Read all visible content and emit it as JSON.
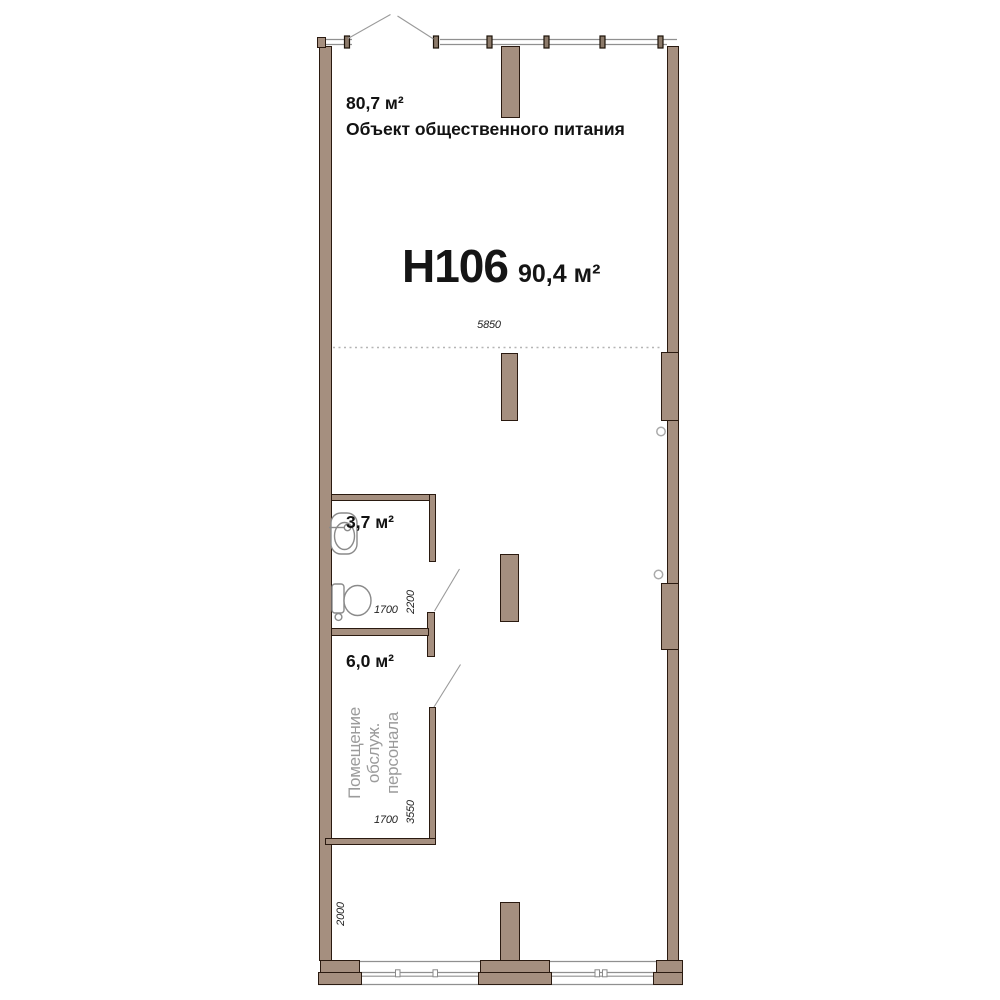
{
  "unit": {
    "id": "Н106",
    "area": "90,4 м²"
  },
  "zones": {
    "catering": {
      "area": "80,7 м²",
      "name": "Объект общественного питания"
    },
    "bathroom": {
      "area": "3,7 м²"
    },
    "staff": {
      "area": "6,0 м²",
      "name_lines": [
        "Помещение",
        "обслуж.",
        "персонала"
      ]
    }
  },
  "dimensions": {
    "hall_width": "5850",
    "bathroom_width": "1700",
    "bathroom_depth": "2200",
    "staff_width": "1700",
    "staff_depth": "3550",
    "left_offset": "2000"
  },
  "icons": [
    "sink-icon",
    "toilet-icon",
    "door-swing-icon",
    "storefront-glazing",
    "dashed-zone-divider",
    "door-axis-marker"
  ],
  "colors": {
    "wall_fill": "#a58f7f",
    "wall_outline": "#2a1a10",
    "glazing_line": "#909090",
    "door_swing_line": "#9a9a9a",
    "fixture_outline": "#8a8a8a",
    "dim_text": "#222222",
    "muted_label": "#9b9b9b"
  }
}
